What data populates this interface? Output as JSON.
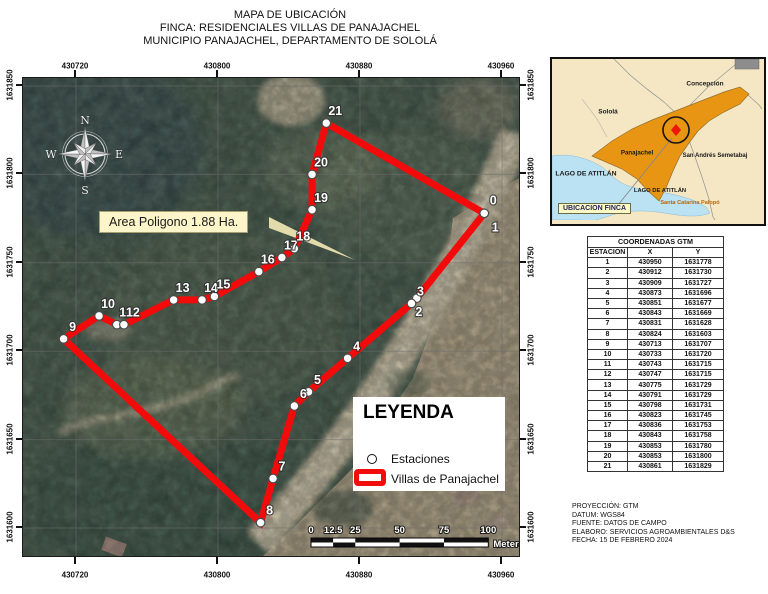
{
  "title": {
    "line1": "MAPA DE UBICACIÓN",
    "line2": "FINCA: RESIDENCIALES VILLAS DE PANAJACHEL",
    "line3": "MUNICIPIO PANAJACHEL, DEPARTAMENTO DE SOLOLÁ"
  },
  "map": {
    "area_label": "Area Poligono 1.88 Ha.",
    "origin_label": "0",
    "x_ticks": [
      430720,
      430800,
      430880,
      430960
    ],
    "y_ticks": [
      1631850,
      1631800,
      1631750,
      1631700,
      1631650,
      1631600
    ],
    "compass": {
      "north": "N",
      "south": "S",
      "east": "E",
      "west": "W"
    },
    "scalebar": {
      "ticks": [
        0,
        12.5,
        25,
        50,
        75,
        100
      ],
      "unit": "Meters"
    }
  },
  "legend": {
    "title": "LEYENDA",
    "items": [
      {
        "symbol": "station-circle",
        "label": "Estaciones"
      },
      {
        "symbol": "parcel-outline",
        "label": "Villas de Panajachel"
      }
    ]
  },
  "inset": {
    "labels": [
      {
        "text": "Concepción"
      },
      {
        "text": "Sololá"
      },
      {
        "text": "Panajachel"
      },
      {
        "text": "San Andrés Semetabaj"
      },
      {
        "text": "LAGO DE ATITLÁN"
      },
      {
        "text": "LAGO DE ATITLÁN"
      },
      {
        "text": "Santa Catarina Palopó"
      }
    ],
    "callout": "UBICACION FINCA"
  },
  "table": {
    "title": "COORDENADAS GTM",
    "columns": [
      "ESTACION",
      "X",
      "Y"
    ],
    "rows": [
      [
        1,
        430950,
        1631778
      ],
      [
        2,
        430912,
        1631730
      ],
      [
        3,
        430909,
        1631727
      ],
      [
        4,
        430873,
        1631696
      ],
      [
        5,
        430851,
        1631677
      ],
      [
        6,
        430843,
        1631669
      ],
      [
        7,
        430831,
        1631628
      ],
      [
        8,
        430824,
        1631603
      ],
      [
        9,
        430713,
        1631707
      ],
      [
        10,
        430733,
        1631720
      ],
      [
        11,
        430743,
        1631715
      ],
      [
        12,
        430747,
        1631715
      ],
      [
        13,
        430775,
        1631729
      ],
      [
        14,
        430791,
        1631729
      ],
      [
        15,
        430798,
        1631731
      ],
      [
        16,
        430823,
        1631745
      ],
      [
        17,
        430836,
        1631753
      ],
      [
        18,
        430843,
        1631758
      ],
      [
        19,
        430853,
        1631780
      ],
      [
        20,
        430853,
        1631800
      ],
      [
        21,
        430861,
        1631829
      ]
    ]
  },
  "notes": [
    "PROYECCIÓN: GTM",
    "DATUM: WGS84",
    "FUENTE: DATOS DE CAMPO",
    "ELABORO: SERVICIOS AGROAMBIENTALES D&S",
    "FECHA: 15 DE FEBRERO 2024"
  ],
  "colors": {
    "parcel": "#f30b0b",
    "municipality": "#e7930d",
    "lake": "#bbe2f3",
    "callout_bg": "#fdf9c5",
    "area_label_bg": "#fcf5c9"
  }
}
